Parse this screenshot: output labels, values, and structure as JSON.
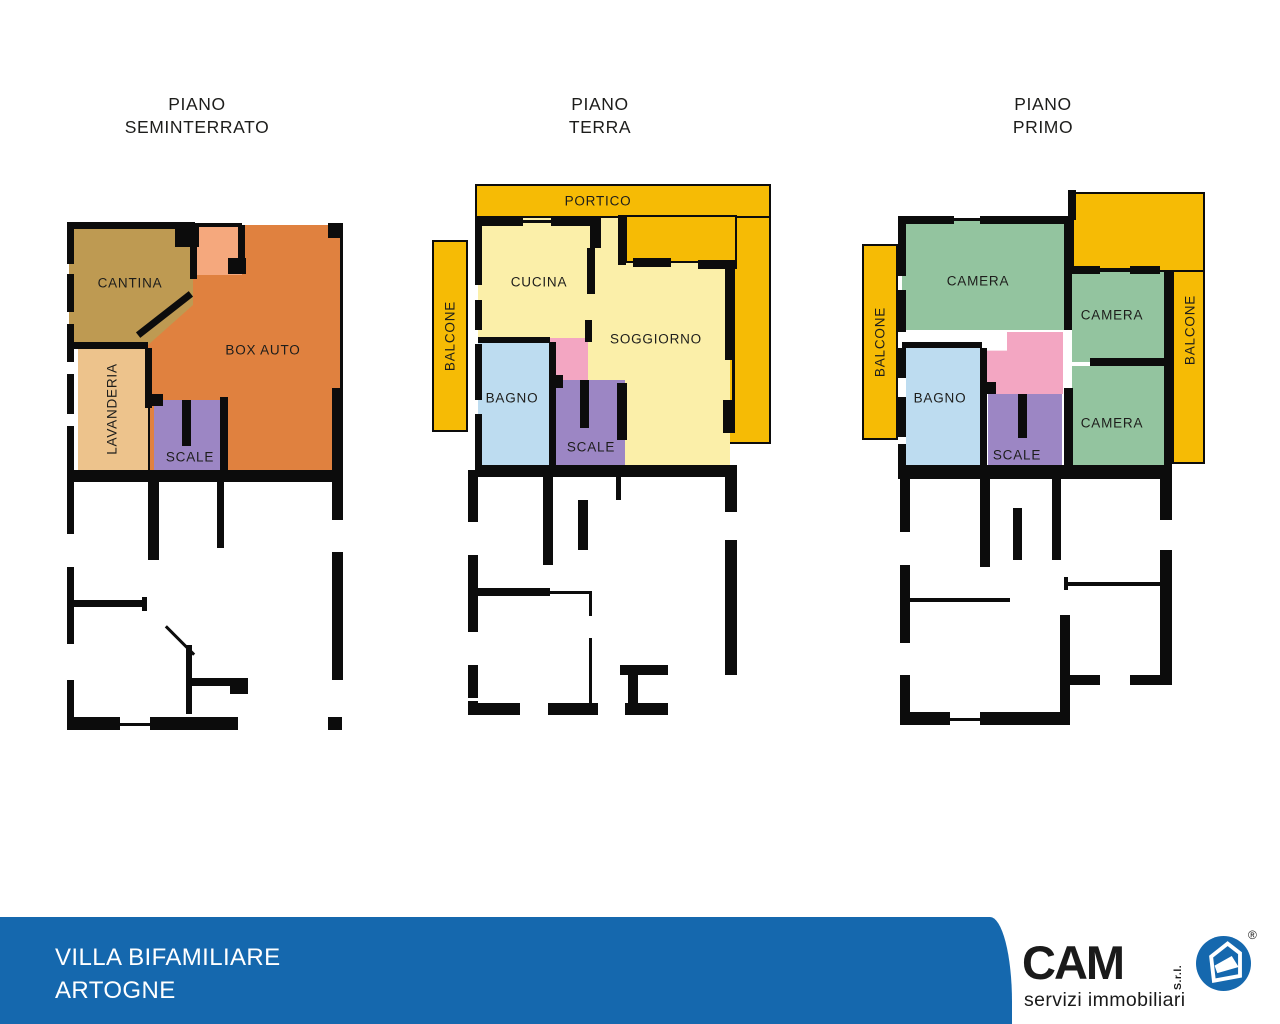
{
  "palette": {
    "wall": "#0C0C0C",
    "ink": "#1D1D1B",
    "gold": "#F6BB05",
    "pale_yellow": "#FBEFA9",
    "orange": "#E0813F",
    "peach": "#F5A87D",
    "tan": "#EDC38C",
    "khaki": "#BE9A52",
    "purple": "#9C86C4",
    "light_blue": "#BDDCF0",
    "pink": "#F3A6C2",
    "green": "#93C49F",
    "footer_blue": "#1568AE"
  },
  "plans": [
    {
      "title_line1": "PIANO",
      "title_line2": "SEMINTERRATO",
      "labels": {
        "cantina": "CANTINA",
        "box_auto": "BOX AUTO",
        "lavanderia": "LAVANDERIA",
        "scale": "SCALE"
      }
    },
    {
      "title_line1": "PIANO",
      "title_line2": "TERRA",
      "labels": {
        "portico": "PORTICO",
        "balcone": "BALCONE",
        "cucina": "CUCINA",
        "soggiorno": "SOGGIORNO",
        "bagno": "BAGNO",
        "scale": "SCALE"
      }
    },
    {
      "title_line1": "PIANO",
      "title_line2": "PRIMO",
      "labels": {
        "balcone_left": "BALCONE",
        "balcone_right": "BALCONE",
        "camera_1": "CAMERA",
        "camera_2": "CAMERA",
        "camera_3": "CAMERA",
        "bagno": "BAGNO",
        "scale": "SCALE"
      }
    }
  ],
  "footer": {
    "line1": "VILLA BIFAMILIARE",
    "line2": "ARTOGNE"
  },
  "logo": {
    "name": "CAM",
    "legal": "S.r.l.",
    "registered": "®",
    "tagline": "servizi immobiliari"
  }
}
